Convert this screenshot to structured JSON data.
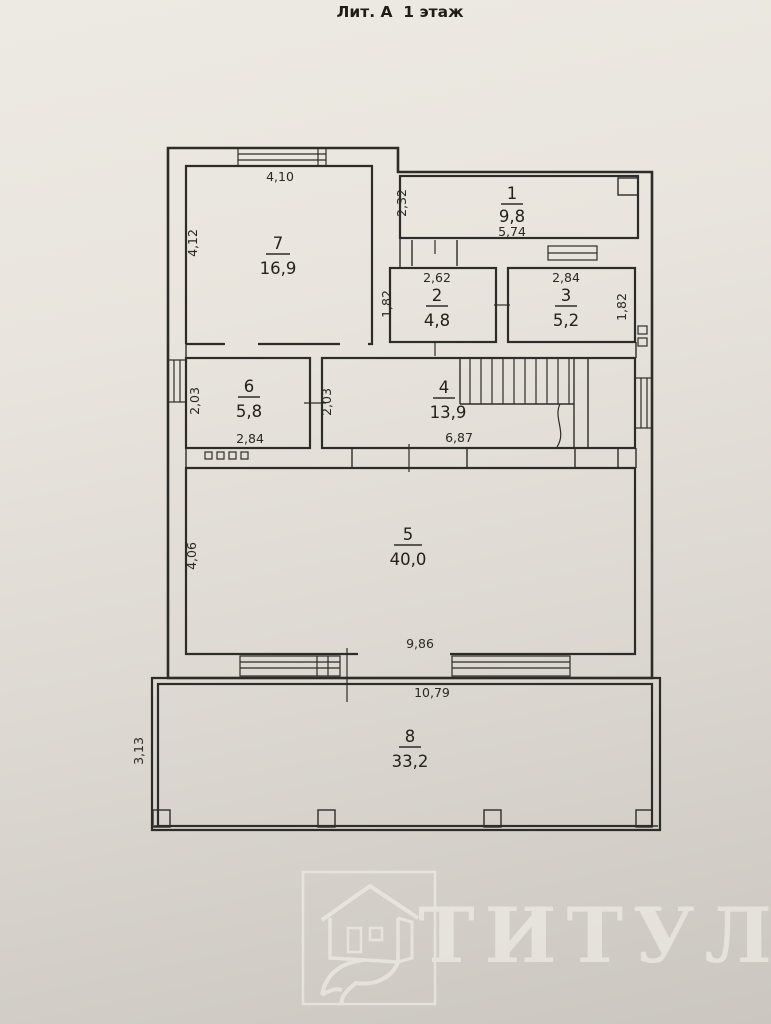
{
  "title": "Лит. А  1 этаж",
  "colors": {
    "ink": "#2e2c28",
    "paper": "#e8e4dd",
    "watermark": "#f4f1ea"
  },
  "rooms": {
    "r1": {
      "number": "1",
      "area": "9,8"
    },
    "r2": {
      "number": "2",
      "area": "4,8"
    },
    "r3": {
      "number": "3",
      "area": "5,2"
    },
    "r4": {
      "number": "4",
      "area": "13,9"
    },
    "r5": {
      "number": "5",
      "area": "40,0"
    },
    "r6": {
      "number": "6",
      "area": "5,8"
    },
    "r7": {
      "number": "7",
      "area": "16,9"
    },
    "r8": {
      "number": "8",
      "area": "33,2"
    }
  },
  "dims": {
    "r7_top": "4,10",
    "r7_left": "4,12",
    "r1_left": "2,32",
    "r1_bottom": "5,74",
    "r2_top": "2,62",
    "r2_left": "1,82",
    "r3_top": "2,84",
    "r3_right": "1,82",
    "r6_left": "2,03",
    "r6_bottom": "2,84",
    "r4_left": "2,03",
    "r4_bottom": "6,87",
    "r5_left": "4,06",
    "r5_bottom": "9,86",
    "r8_top": "10,79",
    "r8_left": "3,13"
  },
  "watermark": {
    "text": "ТИТУЛ"
  }
}
